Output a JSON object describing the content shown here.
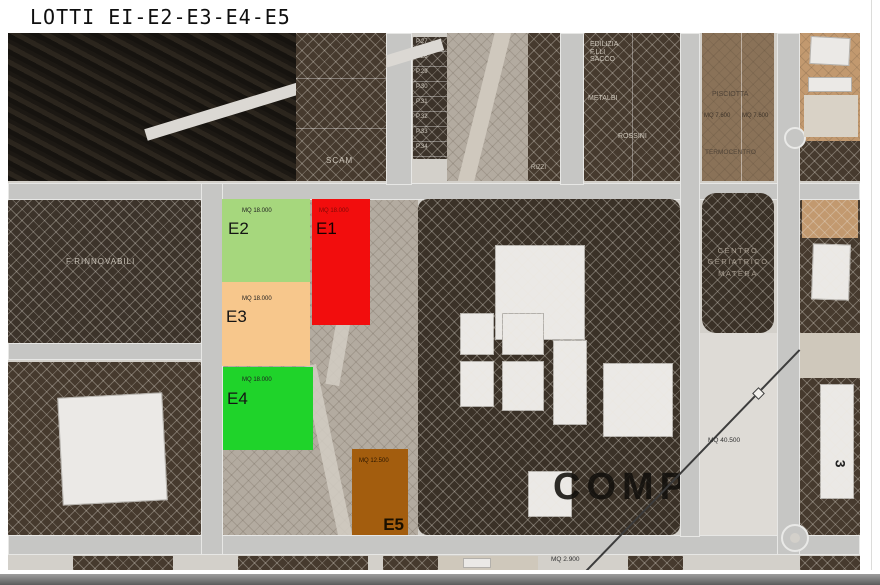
{
  "page": {
    "title": "LOTTI EI-E2-E3-E4-E5"
  },
  "lots": [
    {
      "id": "E1",
      "mq": "MQ 18.000",
      "color": "#f20d0d"
    },
    {
      "id": "E2",
      "mq": "MQ 18.000",
      "color": "#a6d77d"
    },
    {
      "id": "E3",
      "mq": "MQ 18.000",
      "color": "#f7c78c"
    },
    {
      "id": "E4",
      "mq": "MQ 18.000",
      "color": "#1fd32a"
    },
    {
      "id": "E5",
      "mq": "MQ 12.500",
      "color": "#a35d0e"
    }
  ],
  "labels": {
    "scam": "SCAM",
    "rizzi": "RIZZI",
    "edilizia_1": "EDILIZIA",
    "edilizia_2": "F.LLI",
    "edilizia_3": "SACCO",
    "metalbi": "METALBI",
    "rossini": "ROSSINI",
    "pisciotta": "PISCIOTTA",
    "mq_7600_a": "MQ 7.600",
    "mq_7600_b": "MQ 7.600",
    "termocentro": "TERMOCENTRO",
    "centro_1": "CENTRO",
    "centro_2": "GERIATRICO",
    "centro_3": "MATERA",
    "rinnovabili": "F.RINNOVABILI",
    "compa": "COMPA",
    "mq_40500": "MQ 40.500",
    "mq_2900": "MQ 2.900",
    "digit_3": "3",
    "p_lots": [
      "P.27",
      "P.28",
      "P.29",
      "P.30",
      "P.31",
      "P.32",
      "P.33",
      "P.34"
    ]
  }
}
